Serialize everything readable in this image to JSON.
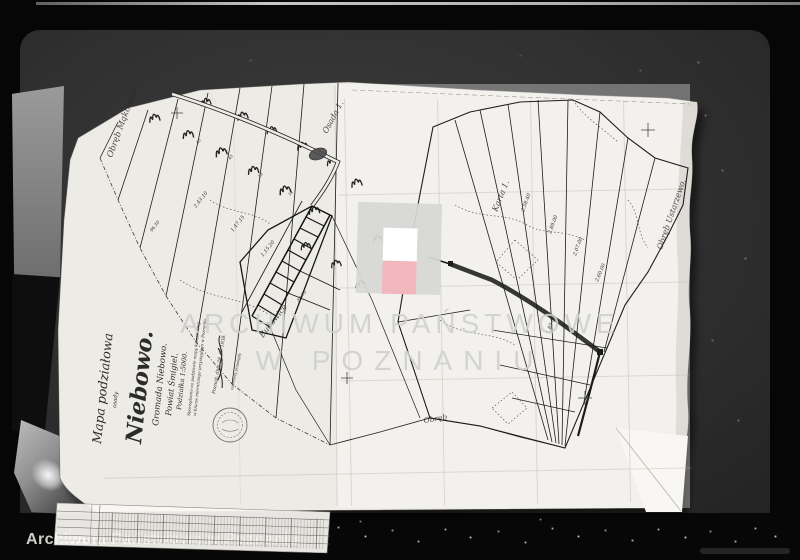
{
  "watermark": {
    "line1": "ARCHIWUM PAŃSTWOWE",
    "line2": "W POZNANIU",
    "footer": "Archiwum Państwowe w Poznaniu"
  },
  "logo": {
    "panel_color": "#d6d8d5",
    "flag_white": "#ffffff",
    "flag_red": "#f2b6bd"
  },
  "title_block": {
    "kind": "Mapa podziałowa",
    "kind_sub": "osady",
    "name": "Niebowo.",
    "gromada": "Gromada Niebowo.",
    "powiat": "Powiat Śmigiel.",
    "scale": "Podziałka 1:5000.",
    "note1": "Sporządzono na podstawie mapy katastralnej",
    "note2": "w biurze mierniczego przysięgłego w Poznaniu.",
    "place_date": "Poznań, dnia 28. IV. 1938.",
    "sig_title": "mierniczy przysięgły"
  },
  "map_labels": {
    "obreb_left": "Obręb Mąkowice",
    "osada": "Osada 1.",
    "karta": "Karta 1.",
    "obreb_right": "Obręb Ustarzewo.",
    "strip_name": "Budowice",
    "obreb_bottom": "Obręb"
  },
  "parcel_numbers": [
    "2.58.40",
    "2.89.00",
    "2.07.00",
    "2.60.00",
    "1.85.00",
    "2.43.10",
    "1.47.15",
    "1.15.20",
    "96.30",
    "88.75",
    "43",
    "45",
    "28",
    "12"
  ]
}
